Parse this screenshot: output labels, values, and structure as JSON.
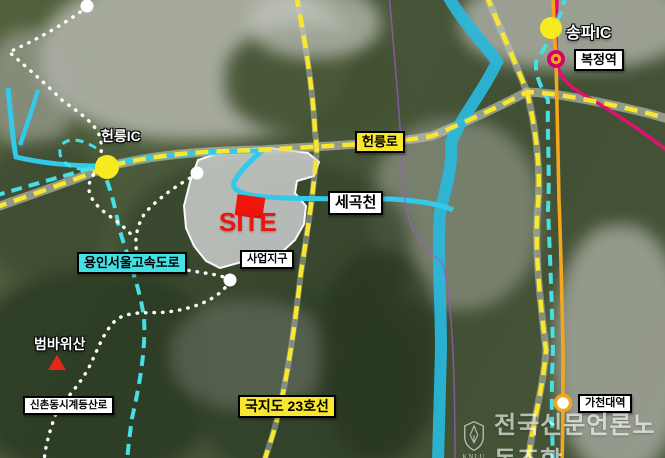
{
  "map": {
    "markers": {
      "songpa_ic": {
        "label": "송파IC"
      },
      "bokjeong_station": {
        "label": "복정역"
      },
      "heolleung_ic": {
        "label": "헌릉IC"
      },
      "gacheon_station": {
        "label": "가천대역"
      }
    },
    "roads": {
      "heolleung_ro": {
        "label": "헌릉로"
      },
      "national_route_23": {
        "label": "국지도 23호선"
      },
      "yongin_seoul_expressway": {
        "label": "용인서울고속도로"
      }
    },
    "water": {
      "segok_stream": {
        "label": "세곡천"
      }
    },
    "site": {
      "label": "SITE",
      "district_label": "사업지구"
    },
    "terrain": {
      "beombawi_mountain": {
        "label": "범바위산"
      },
      "sinchon_trail": {
        "label": "신촌동시계등산로"
      }
    },
    "watermark": {
      "org": "전국신문언론노동조합",
      "abbr": "KNLU"
    },
    "palette": {
      "road_dash_yellow": "#f9e62e",
      "expressway_cyan": "#45e0e4",
      "stream_cyan": "#2fc4e4",
      "rail_orange": "#f2a71e",
      "metro_pink": "#e0116e",
      "thin_purple": "#a05ac0",
      "marker_yellow": "#f7ea1e",
      "station_magenta": "#d6006e",
      "site_red": "#ee150a",
      "trail_white": "#ffffff"
    }
  }
}
